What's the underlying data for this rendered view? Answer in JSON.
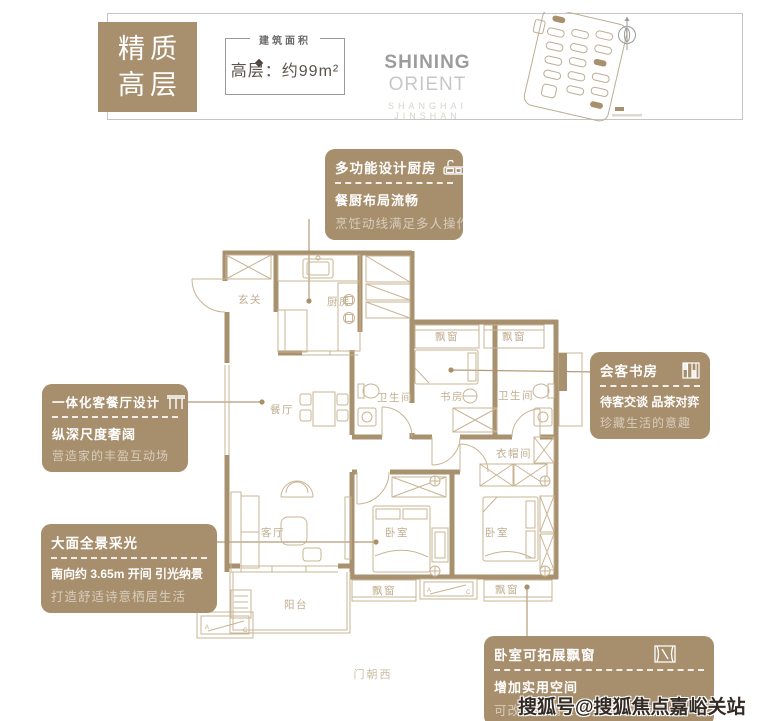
{
  "header": {
    "badge1": "精质",
    "badge2": "高层",
    "area_label": "建筑面积",
    "area_value": "高层：约99m²",
    "brand_main": "SHINING",
    "brand_sub": "ORIENT",
    "brand_tagline": "SHANGHAI JINSHAN"
  },
  "callouts": {
    "kitchen": {
      "title": "多功能设计厨房",
      "line1": "餐厨布局流畅",
      "line2": "烹饪动线满足多人操作"
    },
    "living": {
      "title": "一体化客餐厅设计",
      "line1": "纵深尺度奢阔",
      "line2": "营造家的丰盈互动场"
    },
    "daylight": {
      "title": "大面全景采光",
      "line1": "南向约 3.65m 开间 引光纳景",
      "line2": "打造舒适诗意栖居生活"
    },
    "study": {
      "title": "会客书房",
      "line1": "待客交谈 品茶对弈",
      "line2": "珍藏生活的意趣"
    },
    "baywindow": {
      "title": "卧室可拓展飘窗",
      "line1": "增加实用空间",
      "line2": "可改造榻榻米或小型阅读角"
    }
  },
  "floorplan": {
    "rooms": {
      "entry": "玄关",
      "kitchen": "厨房",
      "dining": "餐厅",
      "bath": "卫生间",
      "study": "书房",
      "cloak": "衣帽间",
      "living": "客厅",
      "bedroom": "卧室",
      "balcony": "阳台",
      "bay": "飘窗"
    },
    "ac_a": "A",
    "ac_c": "C",
    "door_note": "门朝西"
  },
  "watermark": "搜狐号@搜狐焦点嘉峪关站",
  "colors": {
    "accent": "#a8906f",
    "wall": "#a8916f",
    "thin_line": "#c8b494",
    "room_label": "#bfae90",
    "watermark_text": "#322a23"
  }
}
